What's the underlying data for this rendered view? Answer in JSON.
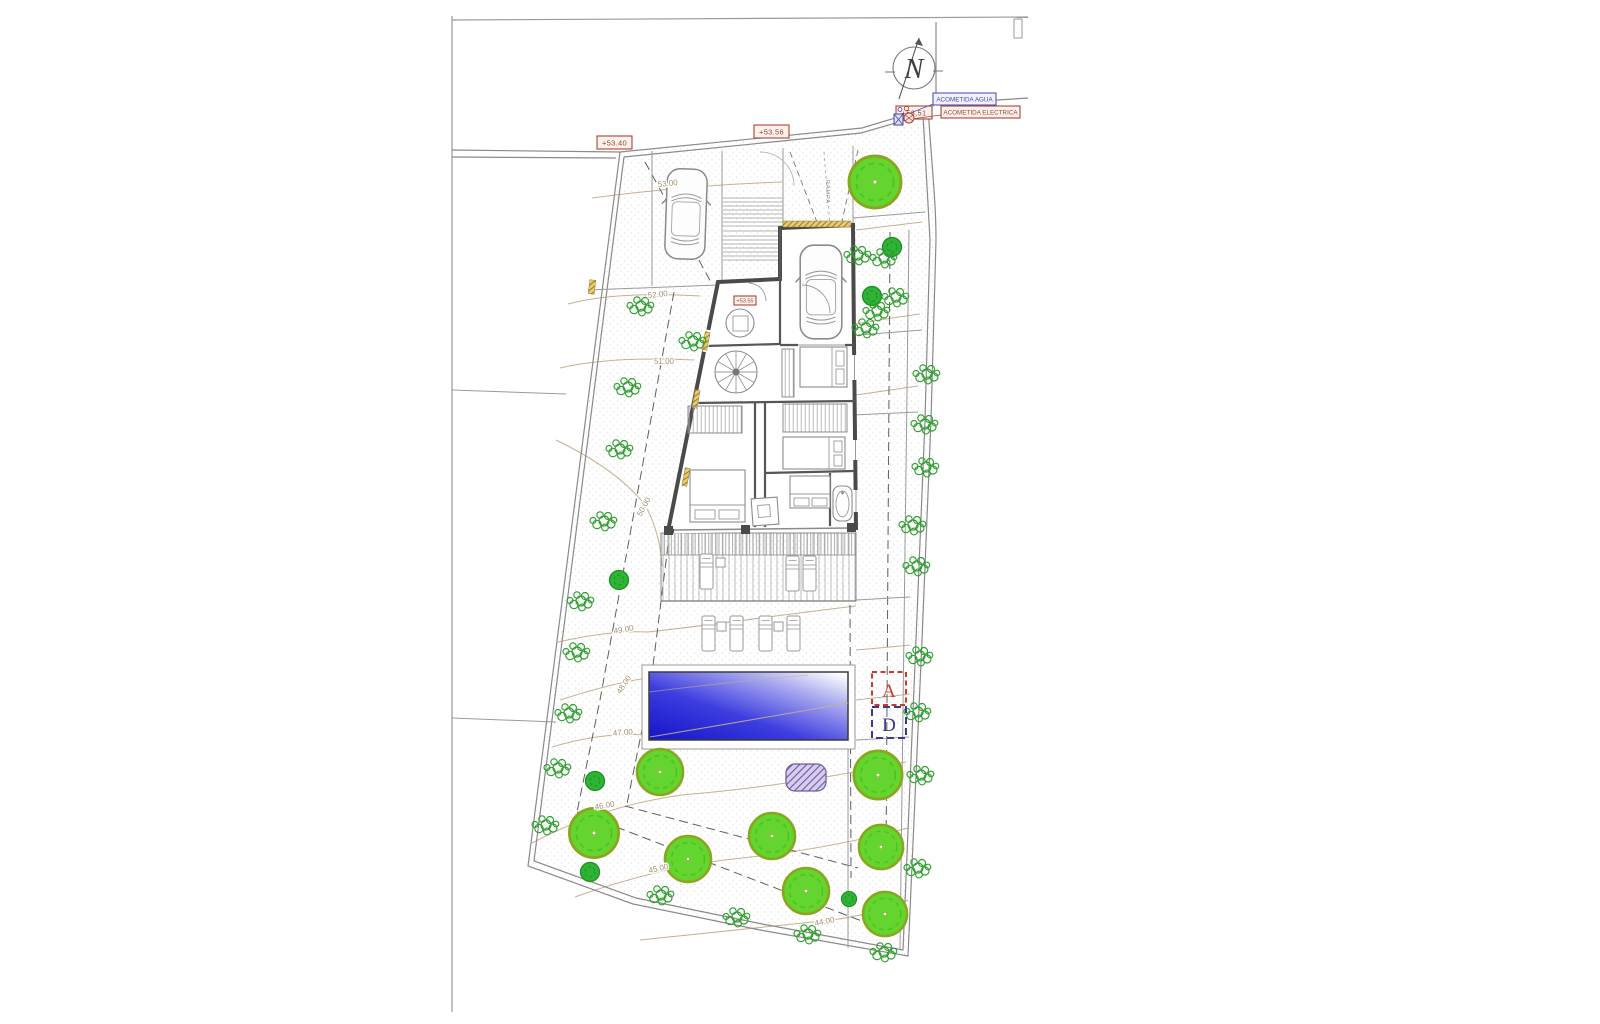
{
  "drawing": {
    "type": "site-plan",
    "north_label": "N",
    "ramp_label": "RAMPA"
  },
  "levels": {
    "street_1": "+53.40",
    "street_2": "+53.56",
    "street_3": "+53,51",
    "entry": "+53.55"
  },
  "utilities": {
    "water": "ACOMETIDA AGUA",
    "electric": "ACOMETIDA ELECTRICA"
  },
  "contours": [
    {
      "label": "53.00"
    },
    {
      "label": "52.00"
    },
    {
      "label": "51.00"
    },
    {
      "label": "50.00"
    },
    {
      "label": "49.00"
    },
    {
      "label": "48.00"
    },
    {
      "label": "47.00"
    },
    {
      "label": "46.00"
    },
    {
      "label": "45.00"
    },
    {
      "label": "44.00"
    }
  ],
  "sections": {
    "a": "A",
    "d": "D"
  },
  "colors": {
    "label_red": "#aa4434",
    "label_blue": "#5353b4",
    "tree_green": "#64d42e",
    "shrub_green": "#2f9e2f",
    "pool_blue": "#1414c8",
    "wall_gray": "#4a4a4a",
    "contour_tan": "#c6b190",
    "purple_area": "#6a5a9a",
    "window_tan": "#c8a23c",
    "section_a": "#cc3a2e",
    "section_d": "#3a3a8c"
  }
}
